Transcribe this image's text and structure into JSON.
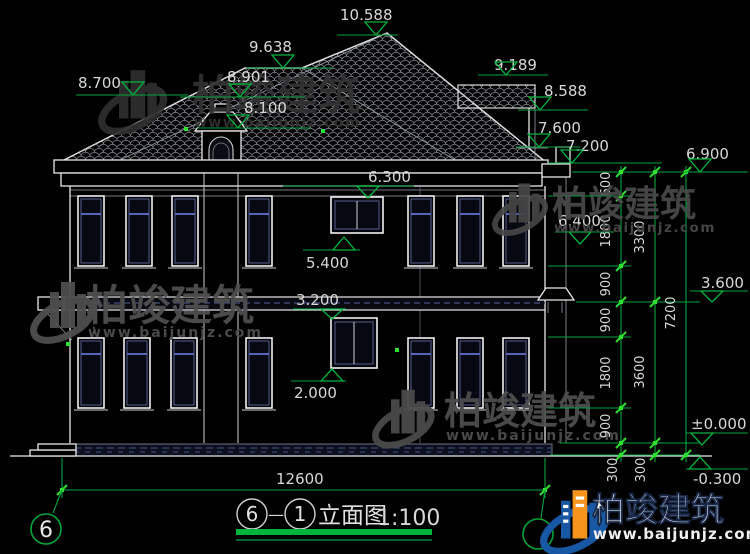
{
  "watermark": {
    "brand": "柏竣建筑",
    "url": "www.baijunjz.com"
  },
  "title_bar": {
    "axis_from": "6",
    "separator": "—",
    "axis_to": "1",
    "drawing_name": "立面图",
    "scale": "1:100"
  },
  "grid_bubble": {
    "left": "6"
  },
  "elevation_marks": {
    "m10588": "10.588",
    "m9638": "9.638",
    "m8901": "8.901",
    "m8700": "8.700",
    "m8100": "8.100",
    "m9189": "9.189",
    "m8588": "8.588",
    "m7600": "7.600",
    "m7200": "7.200",
    "m6900": "6.900",
    "m6300": "6.300",
    "m6400": "6.400",
    "m5400": "5.400",
    "m3600": "3.600",
    "m3200": "3.200",
    "m2000": "2.000",
    "m0": "±0.000",
    "mneg300": "-0.300"
  },
  "dim_chain": {
    "inner": [
      "600",
      "1800",
      "900",
      "900",
      "1800",
      "900",
      "300"
    ],
    "middle": [
      "3300",
      "3600",
      "300"
    ],
    "outer": "7200",
    "total_width": "12600"
  },
  "colors": {
    "background": "#000000",
    "line_white": "#e8e8e8",
    "dimension_green": "#00a53c",
    "tick_green": "#2fe02f",
    "glass_blue": "#5566bb",
    "logo_blue": "#1857a4",
    "logo_orange": "#f7941d"
  }
}
